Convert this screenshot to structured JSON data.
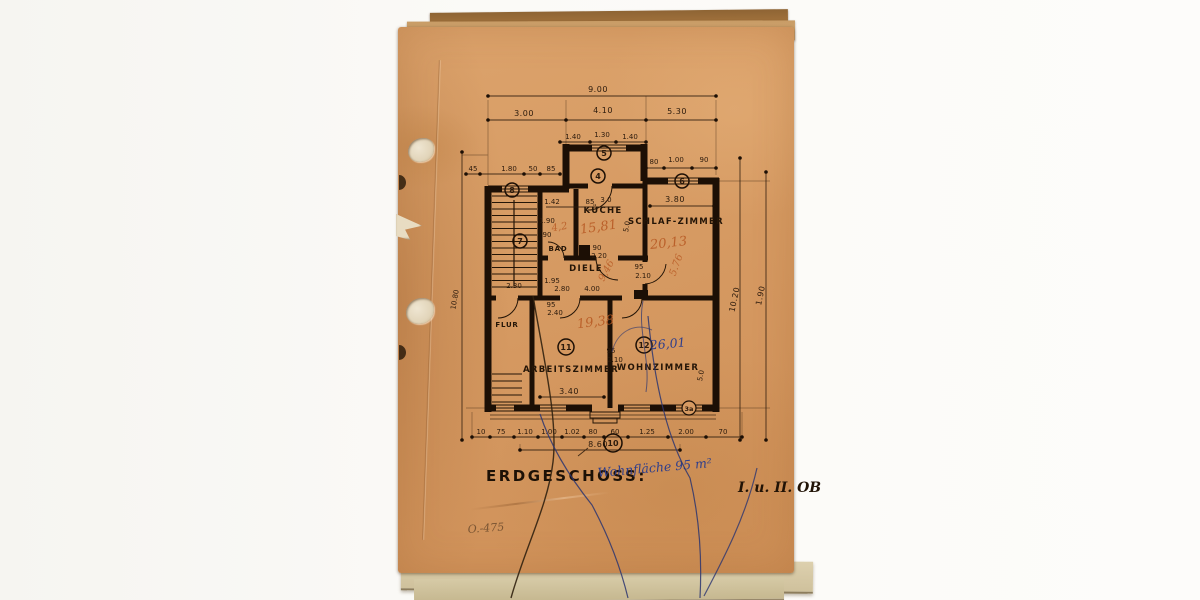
{
  "page": {
    "title": "ERDGESCHOSS:",
    "title_annotation": "Wohnfläche 95 m²",
    "corner_note": "I. u. II. OB",
    "pencil_note": "O.-475"
  },
  "rooms": {
    "kueche": {
      "label": "KÜCHE",
      "area": "15,81"
    },
    "bad": {
      "label": "BAD",
      "area": "4,2"
    },
    "diele": {
      "label": "DIELE",
      "area": "9,46"
    },
    "schlafzimmer": {
      "label": "SCHLAF-ZIMMER",
      "area": "20,13"
    },
    "flur": {
      "label": "FLUR"
    },
    "arbeitszimmer": {
      "label": "ARBEITSZIMMER",
      "area": "19,38"
    },
    "wohnzimmer": {
      "label": "WOHNZIMMER",
      "area": "26,01"
    }
  },
  "dims": {
    "total_width": "9.00",
    "top_row": [
      "3.00",
      "4.10",
      "5.30"
    ],
    "top_row2": [
      "1.40",
      "1.30",
      "1.40"
    ],
    "entry_row": [
      "80",
      "1.00",
      "90"
    ],
    "left_row": [
      "45",
      "1.80",
      "50",
      "85"
    ],
    "kueche_row": [
      "1.42",
      "85",
      "3.0"
    ],
    "kueche_v": "5.0",
    "kueche_small": [
      "90",
      "2.20"
    ],
    "bad_small": [
      "1.90",
      "90"
    ],
    "schlaf_w": "3.80",
    "schlaf_h": "5.76",
    "schlaf_small": [
      "95",
      "2.10"
    ],
    "diele_row": [
      "1.95",
      "2.80",
      "4.00"
    ],
    "stair_w": "2.30",
    "arbeits_small": [
      "95",
      "2.40"
    ],
    "arbeits_w": "3.40",
    "wohn_small": [
      "95",
      "2.10"
    ],
    "wohn_v": "5.0",
    "left_v": "10.80",
    "right_v": "10.20",
    "right_v2": "1.90",
    "bottom_row": [
      "10",
      "75",
      "1.10",
      "1.00",
      "1.02",
      "80",
      "60",
      "1.25",
      "2.00",
      "70"
    ],
    "bottom_total": "8.60"
  },
  "markers": {
    "m4": "4",
    "m5": "5",
    "m6": "6",
    "m7": "7",
    "m8": "8",
    "m10": "10",
    "m11": "11",
    "m12": "12",
    "m3a": "3a"
  }
}
